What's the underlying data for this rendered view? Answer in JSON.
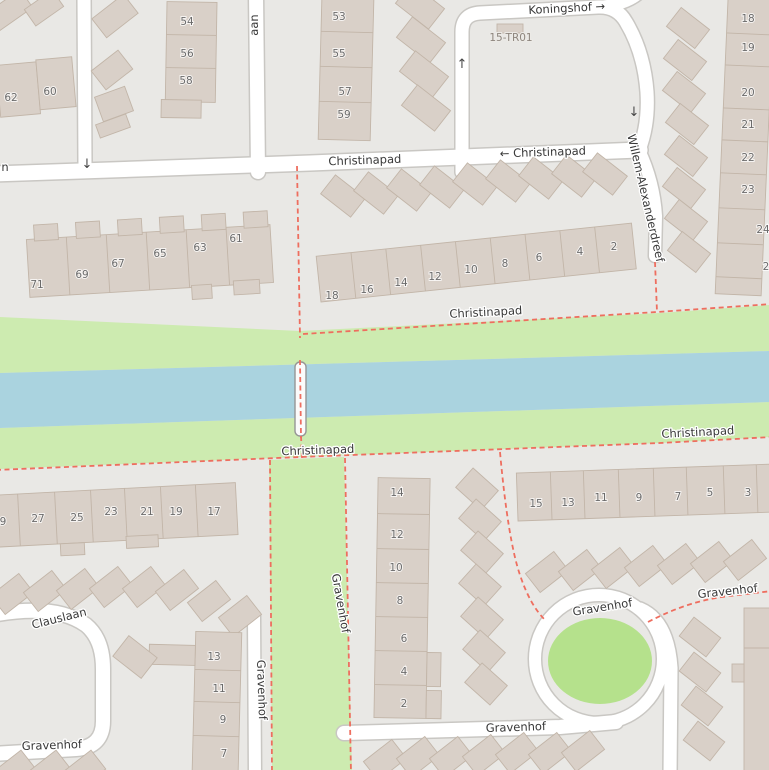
{
  "colors": {
    "background": "#e9e8e5",
    "road": "#ffffff",
    "road_casing": "#c9c7c3",
    "building": "#d9d0c8",
    "building_outline": "#c2b5a8",
    "water": "#aad3df",
    "grass": "#cdebb0",
    "green_circle": "#b5e18c",
    "footpath_dashed": "#ee6e5f",
    "street_label": "#383838",
    "house_number": "#6b6b6b"
  },
  "street_names": [
    "Koningshof",
    "Christinapad",
    "Willem-Alexanderdreef",
    "Gravenhof",
    "Clauslaan"
  ],
  "street_labels": [
    {
      "text": "Koningshof →",
      "x": 567,
      "y": 12,
      "r": -3
    },
    {
      "text": "15-TR01",
      "x": 511,
      "y": 41,
      "r": 0,
      "cls": "ref-label",
      "name": "ref-label-15-tr01"
    },
    {
      "text": "Christinapad",
      "x": 365,
      "y": 164,
      "r": -2
    },
    {
      "text": "← Christinapad",
      "x": 543,
      "y": 156,
      "r": -2
    },
    {
      "text": "Willem-Alexanderdreef",
      "x": 642,
      "y": 199,
      "r": 77
    },
    {
      "text": "n",
      "x": 5,
      "y": 171,
      "r": 0
    },
    {
      "text": "aan",
      "x": 258,
      "y": 25,
      "r": -90
    },
    {
      "text": "Christinapad",
      "x": 486,
      "y": 316,
      "r": -3
    },
    {
      "text": "Christinapad",
      "x": 318,
      "y": 454,
      "r": -2
    },
    {
      "text": "Christinapad",
      "x": 698,
      "y": 436,
      "r": -3
    },
    {
      "text": "Gravenhof",
      "x": 337,
      "y": 604,
      "r": 80
    },
    {
      "text": "Gravenhof",
      "x": 258,
      "y": 690,
      "r": 88
    },
    {
      "text": "Gravenhof",
      "x": 52,
      "y": 749,
      "r": -2
    },
    {
      "text": "Gravenhof",
      "x": 603,
      "y": 611,
      "r": -9
    },
    {
      "text": "Gravenhof",
      "x": 728,
      "y": 595,
      "r": -6
    },
    {
      "text": "Gravenhof",
      "x": 516,
      "y": 731,
      "r": -2
    },
    {
      "text": "Clauslaan",
      "x": 60,
      "y": 622,
      "r": -14
    }
  ],
  "house_numbers": [
    {
      "text": "62",
      "x": 11,
      "y": 101
    },
    {
      "text": "60",
      "x": 50,
      "y": 95
    },
    {
      "text": "54",
      "x": 187,
      "y": 25
    },
    {
      "text": "56",
      "x": 187,
      "y": 57
    },
    {
      "text": "58",
      "x": 186,
      "y": 84
    },
    {
      "text": "53",
      "x": 339,
      "y": 20
    },
    {
      "text": "55",
      "x": 339,
      "y": 57
    },
    {
      "text": "57",
      "x": 345,
      "y": 95
    },
    {
      "text": "59",
      "x": 344,
      "y": 118
    },
    {
      "text": "18",
      "x": 748,
      "y": 22
    },
    {
      "text": "19",
      "x": 748,
      "y": 51
    },
    {
      "text": "20",
      "x": 748,
      "y": 96
    },
    {
      "text": "21",
      "x": 748,
      "y": 128
    },
    {
      "text": "22",
      "x": 748,
      "y": 161
    },
    {
      "text": "23",
      "x": 748,
      "y": 193
    },
    {
      "text": "24",
      "x": 763,
      "y": 233
    },
    {
      "text": "2",
      "x": 766,
      "y": 270
    },
    {
      "text": "71",
      "x": 37,
      "y": 288
    },
    {
      "text": "69",
      "x": 82,
      "y": 278
    },
    {
      "text": "67",
      "x": 118,
      "y": 267
    },
    {
      "text": "65",
      "x": 160,
      "y": 257
    },
    {
      "text": "63",
      "x": 200,
      "y": 251
    },
    {
      "text": "61",
      "x": 236,
      "y": 242
    },
    {
      "text": "18",
      "x": 332,
      "y": 299
    },
    {
      "text": "16",
      "x": 367,
      "y": 293
    },
    {
      "text": "14",
      "x": 401,
      "y": 286
    },
    {
      "text": "12",
      "x": 435,
      "y": 280
    },
    {
      "text": "10",
      "x": 471,
      "y": 273
    },
    {
      "text": "8",
      "x": 505,
      "y": 267
    },
    {
      "text": "6",
      "x": 539,
      "y": 261
    },
    {
      "text": "4",
      "x": 580,
      "y": 255
    },
    {
      "text": "2",
      "x": 614,
      "y": 250
    },
    {
      "text": "9",
      "x": 3,
      "y": 525
    },
    {
      "text": "27",
      "x": 38,
      "y": 522
    },
    {
      "text": "25",
      "x": 77,
      "y": 521
    },
    {
      "text": "23",
      "x": 111,
      "y": 515
    },
    {
      "text": "21",
      "x": 147,
      "y": 515
    },
    {
      "text": "19",
      "x": 176,
      "y": 515
    },
    {
      "text": "17",
      "x": 214,
      "y": 515
    },
    {
      "text": "15",
      "x": 536,
      "y": 507
    },
    {
      "text": "13",
      "x": 568,
      "y": 506
    },
    {
      "text": "11",
      "x": 601,
      "y": 501
    },
    {
      "text": "9",
      "x": 639,
      "y": 501
    },
    {
      "text": "7",
      "x": 678,
      "y": 500
    },
    {
      "text": "5",
      "x": 710,
      "y": 496
    },
    {
      "text": "3",
      "x": 748,
      "y": 496
    },
    {
      "text": "14",
      "x": 397,
      "y": 496
    },
    {
      "text": "12",
      "x": 397,
      "y": 538
    },
    {
      "text": "10",
      "x": 396,
      "y": 571
    },
    {
      "text": "8",
      "x": 400,
      "y": 604
    },
    {
      "text": "6",
      "x": 404,
      "y": 642
    },
    {
      "text": "4",
      "x": 404,
      "y": 675
    },
    {
      "text": "2",
      "x": 404,
      "y": 707
    },
    {
      "text": "13",
      "x": 214,
      "y": 660
    },
    {
      "text": "11",
      "x": 219,
      "y": 692
    },
    {
      "text": "9",
      "x": 223,
      "y": 723
    },
    {
      "text": "7",
      "x": 224,
      "y": 757
    }
  ],
  "oneway_arrows": [
    {
      "text": "↓",
      "x": 87,
      "y": 168
    },
    {
      "text": "↑",
      "x": 462,
      "y": 68
    },
    {
      "text": "↓",
      "x": 634,
      "y": 116
    }
  ]
}
